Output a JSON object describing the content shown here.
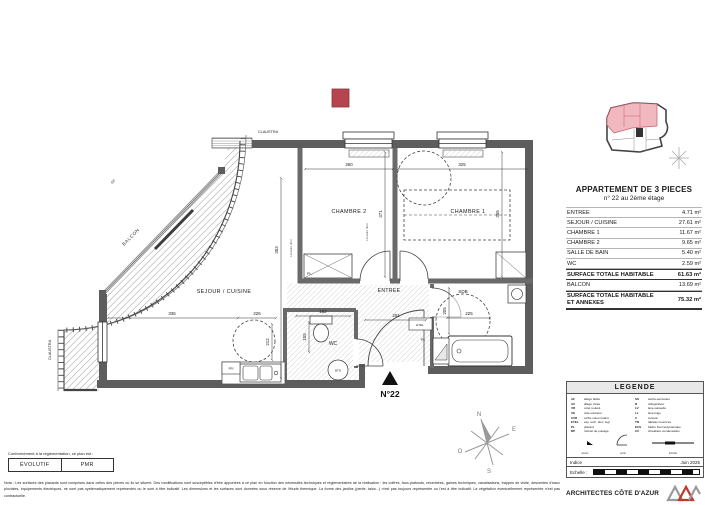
{
  "colors": {
    "marker": "#b5454f",
    "marker_edge": "#8e343d",
    "keyplan_fill": "#f1b8c0",
    "keyplan_line": "#c25e69",
    "accent_red": "#c0392b"
  },
  "plan": {
    "unit": "N°22",
    "rooms": {
      "chambre2": "CHAMBRE 2",
      "chambre1": "CHAMBRE 1",
      "sejour": "SEJOUR / CUISINE",
      "entree": "ENTREE",
      "sdb": "SDB",
      "wc": "WC",
      "balcon": "BALCON"
    },
    "dims": {
      "chambre2_width": "260",
      "chambre1_width": "325",
      "chambre2_depth": "371",
      "chambre1_depth": "355",
      "sejour_depth": "353",
      "sejour_width": "336",
      "sejour_circle": "226",
      "cuisine": "212",
      "entree": "201",
      "wc_width": "152",
      "wc_depth": "105",
      "sdb_width": "225",
      "sdb_depth": "205"
    },
    "labels": {
      "claustra": "CLAUSTRA",
      "gc": "GC",
      "pl_dot": "PL.",
      "pl": "PL",
      "etel": "ETEL",
      "fri": "FRI",
      "btd": "BTD",
      "lineaire": "Linéaire libre"
    },
    "compass": {
      "n": "N",
      "e": "E",
      "s": "S",
      "o": "O"
    }
  },
  "surface_table": {
    "title": "APPARTEMENT DE 3 PIECES",
    "subtitle": "n° 22 au 2ème étage",
    "rows": [
      {
        "label": "ENTREE",
        "value": "4.71 m²"
      },
      {
        "label": "SEJOUR / CUISINE",
        "value": "27.61 m²"
      },
      {
        "label": "CHAMBRE 1",
        "value": "11.67 m²"
      },
      {
        "label": "CHAMBRE 2",
        "value": "9.65 m²"
      },
      {
        "label": "SALLE DE BAIN",
        "value": "5.40 m²"
      },
      {
        "label": "WC",
        "value": "2.59 m²"
      }
    ],
    "total": {
      "label": "SURFACE TOTALE HABITABLE",
      "value": "61.63 m²"
    },
    "balcon": {
      "label": "BALCON",
      "value": "13.69 m²"
    },
    "grand": {
      "label": "SURFACE TOTALE HABITABLE ET ANNEXES",
      "value": "75.32 m²"
    }
  },
  "legend": {
    "title": "LEGENDE",
    "left": [
      {
        "k": "AF",
        "v": "allège faible"
      },
      {
        "k": "AV",
        "v": "allège vitrée"
      },
      {
        "k": "VR",
        "v": "volet roulant"
      },
      {
        "k": "VE",
        "v": "vide extérieur"
      },
      {
        "k": "CVR",
        "v": "coffre volet roulant"
      },
      {
        "k": "ETEL",
        "v": "esp. tech. élec. logt"
      },
      {
        "k": "PL",
        "v": "placard"
      },
      {
        "k": "RP",
        "v": "robinet de puisage"
      }
    ],
    "right": [
      {
        "k": "SS",
        "v": "sèche-serviettes"
      },
      {
        "k": "R",
        "v": "réfrigérateur"
      },
      {
        "k": "LV",
        "v": "lave-vaisselle"
      },
      {
        "k": "LL",
        "v": "lave-linge"
      },
      {
        "k": "C",
        "v": "cuisson"
      },
      {
        "k": "TN",
        "v": "tableau nourrices"
      },
      {
        "k": "ECS",
        "v": "ballon thermodynamique"
      },
      {
        "k": "CC",
        "v": "chaudière condensation"
      }
    ],
    "sym_left": "accès",
    "sym_mid": "porte",
    "sym_right": "échelle",
    "indice_label": "Indice",
    "date": "Juin 2025",
    "echelle_label": "Echelle :"
  },
  "firm": {
    "name": "ARCHITECTES CÔTE D'AZUR",
    "logo": "ACA"
  },
  "stamp": {
    "intro": "Conformément à la réglementation, ce plan est :",
    "box1": "ÉVOLUTIF",
    "box2": "PMR"
  },
  "footer_note": "Nota : Les surfaces des placards sont comprises dans celles des pièces où ils se situent. Des modifications sont susceptibles d'être apportées à ce plan en fonction des nécessités techniques et réglementaires de la réalisation : les coffres, faux-plafonds, retombées, gaines techniques, canalisations, trappes de visite, descentes d'eaux pluviales, équipements électriques, ne sont pas systématiquement représentés ou le sont à titre indicatif. Les dimensions et les surfaces sont données sous réserve de l'étude thermique. La forme des jardins (pente, talus...) n'est pas toujours représentée ou l'est à titre indicatif. La végétation éventuellement représentée n'est pas contractuelle."
}
